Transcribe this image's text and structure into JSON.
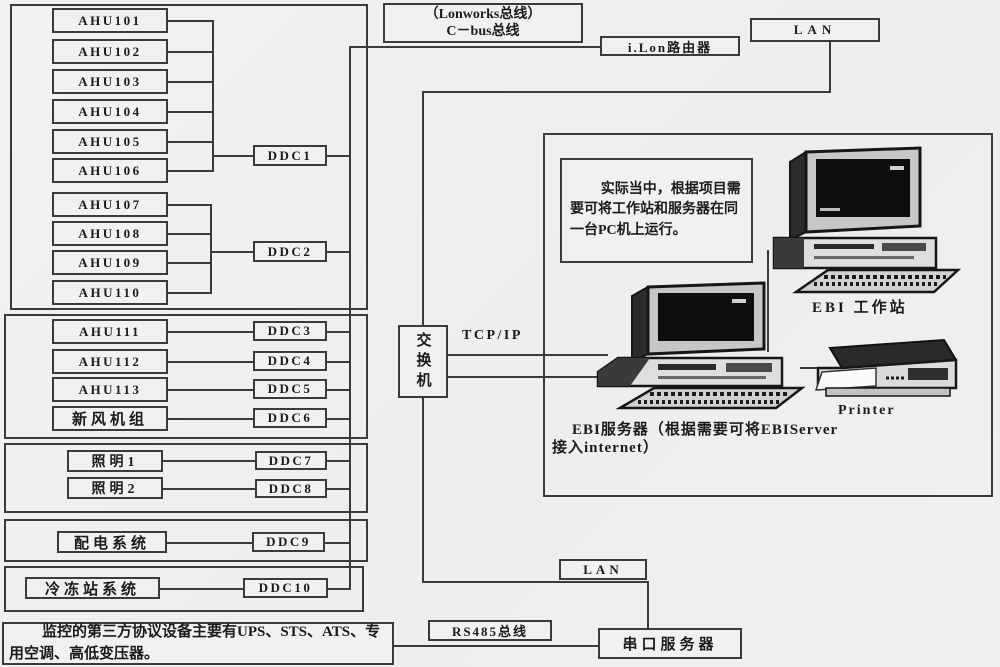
{
  "colors": {
    "background": "#f1f0ee",
    "line": "#3b3b3b",
    "text": "#1b1b1b"
  },
  "top": {
    "lonworks_line1": "（Lonworks总线）",
    "lonworks_line2": "C－bus总线",
    "ilon_router": "i.Lon路由器",
    "lan": "LAN"
  },
  "left": {
    "group1_ahus": [
      "AHU101",
      "AHU102",
      "AHU103",
      "AHU104",
      "AHU105",
      "AHU106"
    ],
    "group1_ddc": "DDC1",
    "group2_ahus": [
      "AHU107",
      "AHU108",
      "AHU109",
      "AHU110"
    ],
    "group2_ddc": "DDC2",
    "group3_rows": [
      {
        "device": "AHU111",
        "ddc": "DDC3"
      },
      {
        "device": "AHU112",
        "ddc": "DDC4"
      },
      {
        "device": "AHU113",
        "ddc": "DDC5"
      },
      {
        "device": "新风机组",
        "ddc": "DDC6"
      }
    ],
    "group4_rows": [
      {
        "device": "照明1",
        "ddc": "DDC7"
      },
      {
        "device": "照明2",
        "ddc": "DDC8"
      }
    ],
    "group5_rows": [
      {
        "device": "配电系统",
        "ddc": "DDC9"
      }
    ],
    "group6_rows": [
      {
        "device": "冷冻站系统",
        "ddc": "DDC10"
      }
    ],
    "third_party_note": "监控的第三方协议设备主要有UPS、STS、ATS、专用空调、高低变压器。"
  },
  "middle": {
    "switch_label": "交换机",
    "tcpip": "TCP/IP"
  },
  "right": {
    "note": "实际当中，根据项目需要可将工作站和服务器在同一台PC机上运行。",
    "workstation_label": "EBI 工作站",
    "printer_label": "Printer",
    "server_caption_line1": "EBI服务器（根据需要可将EBIServer",
    "server_caption_line2": "接入internet）"
  },
  "bottom": {
    "lan": "LAN",
    "rs485_bus": "RS485总线",
    "serial_server": "串口服务器"
  }
}
